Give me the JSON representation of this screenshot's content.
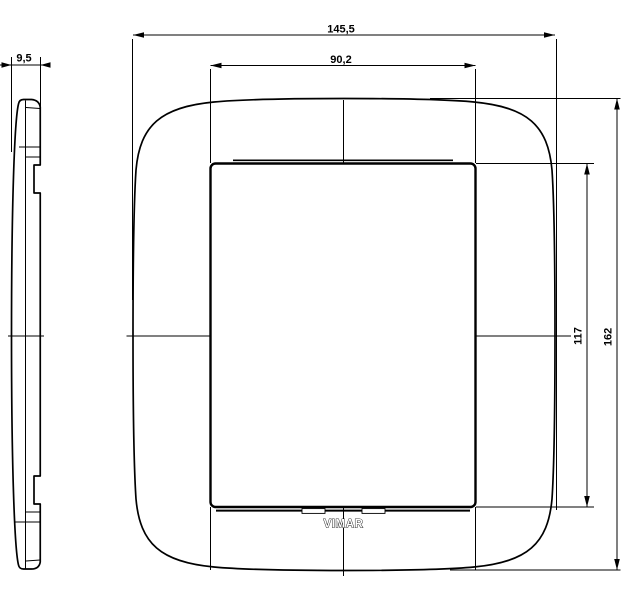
{
  "drawing": {
    "brand_label": "VIMAR",
    "line_color": "#000000",
    "background_color": "#ffffff",
    "dimensions": {
      "side_depth": "9,5",
      "plate_width": "145,5",
      "window_width": "90,2",
      "window_height": "117",
      "plate_height": "162"
    }
  }
}
